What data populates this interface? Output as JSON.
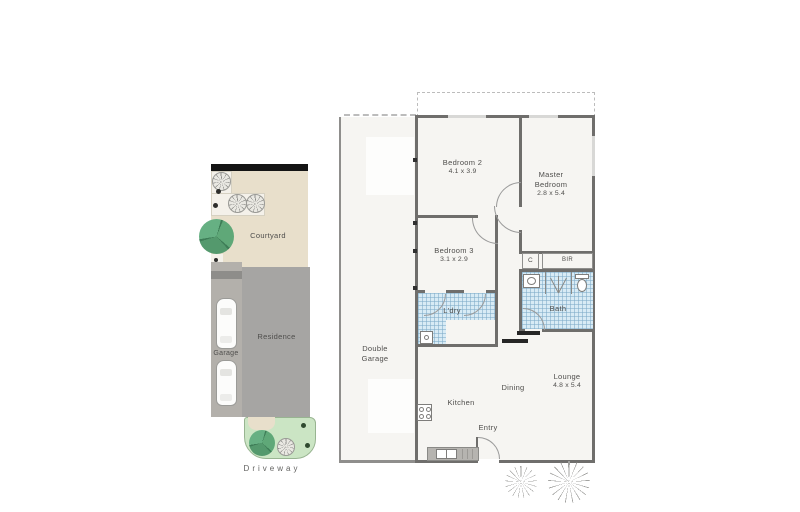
{
  "site_plan": {
    "courtyard": {
      "label": "Courtyard"
    },
    "garage": {
      "label": "Garage"
    },
    "residence": {
      "label": "Residence"
    },
    "driveway": {
      "label": "Driveway"
    }
  },
  "floor_plan": {
    "double_garage": {
      "label": "Double Garage"
    },
    "bedroom2": {
      "label": "Bedroom 2",
      "dims": "4.1 x 3.9"
    },
    "master_bedroom": {
      "label": "Master Bedroom",
      "dims": "2.8 x 5.4"
    },
    "bedroom3": {
      "label": "Bedroom 3",
      "dims": "3.1 x 2.9"
    },
    "cupboard": {
      "label": "C"
    },
    "built_in_robe": {
      "label": "BIR"
    },
    "bath": {
      "label": "Bath"
    },
    "laundry": {
      "label": "L'dry"
    },
    "kitchen": {
      "label": "Kitchen"
    },
    "dining": {
      "label": "Dining"
    },
    "lounge": {
      "label": "Lounge",
      "dims": "4.8 x 5.4"
    },
    "entry": {
      "label": "Entry"
    }
  },
  "colors": {
    "wall": "#6f6e6c",
    "floor": "#f6f5f2",
    "tile_blue": "#d8ebf5",
    "courtyard": "#e8dfcb",
    "planter": "#f4f1ea",
    "residence": "#a6a5a3",
    "garage_strip": "#b3b0ab",
    "garden": "#cbe5c4",
    "tree_green": "#55a06e"
  }
}
